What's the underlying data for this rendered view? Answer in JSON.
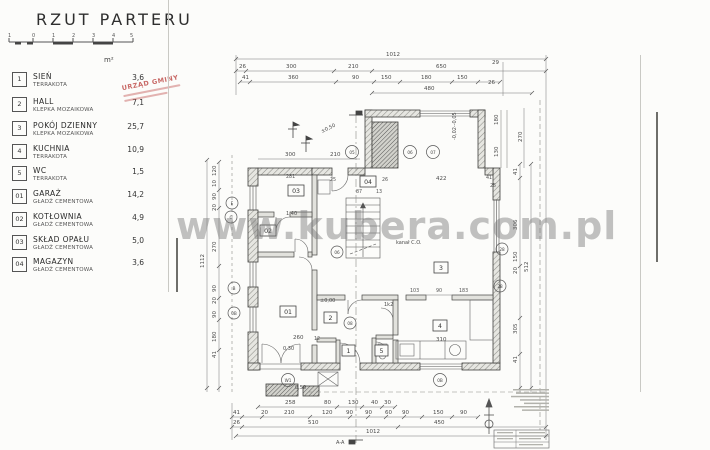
{
  "page": {
    "watermark": "www.kubera.com.pl"
  },
  "stamp": {
    "line1": "URZĄD GMINY"
  },
  "legend": {
    "title": "RZUT PARTERU",
    "unit": "m²",
    "scale_ticks": [
      "1",
      "0",
      "1",
      "2",
      "3",
      "4",
      "5"
    ],
    "rows": [
      {
        "no": "1",
        "name": "SIEŃ",
        "material": "TERRAKOTA",
        "area": "3,6"
      },
      {
        "no": "2",
        "name": "HALL",
        "material": "KLEPKA MOZAIKOWA",
        "area": "7,1"
      },
      {
        "no": "3",
        "name": "POKÓJ DZIENNY",
        "material": "KLEPKA MOZAIKOWA",
        "area": "25,7"
      },
      {
        "no": "4",
        "name": "KUCHNIA",
        "material": "TERRAKOTA",
        "area": "10,9"
      },
      {
        "no": "5",
        "name": "WC",
        "material": "TERRAKOTA",
        "area": "1,5"
      },
      {
        "no": "01",
        "name": "GARAŻ",
        "material": "GŁADŹ CEMENTOWA",
        "area": "14,2"
      },
      {
        "no": "02",
        "name": "KOTŁOWNIA",
        "material": "GŁADŹ CEMENTOWA",
        "area": "4,9"
      },
      {
        "no": "03",
        "name": "SKŁAD OPAŁU",
        "material": "GŁADŹ CEMENTOWA",
        "area": "5,0"
      },
      {
        "no": "04",
        "name": "MAGAZYN",
        "material": "GŁADŹ CEMENTOWA",
        "area": "3,6"
      }
    ]
  },
  "plan": {
    "rooms": {
      "r1": "1",
      "r2": "2",
      "r3": "3",
      "r4": "4",
      "r5": "5",
      "r01": "01",
      "r02": "02",
      "r03": "03",
      "r04": "04"
    },
    "levels": {
      "l000": "±0,00",
      "l050": "±0,50",
      "l030": "0,30",
      "l05": "0,50",
      "l140": "1,40",
      "lm": "-0,02--0,05"
    },
    "notes": {
      "kanal": "kanał C.O.",
      "k2": "1k2",
      "section": "A-A"
    },
    "markers": {
      "m05": "05",
      "m06": "06",
      "m07": "07",
      "m06b": "06",
      "m08": "08",
      "mE": "E",
      "mC": "C",
      "mB": "B",
      "m0B": "0B",
      "m28a": "28",
      "m28b": "28",
      "mW1": "W1",
      "m0Bb": "0B"
    },
    "dims": {
      "total": "1012",
      "btotal": "1012",
      "ltotal": "1112",
      "rtotal": "512",
      "t480": "480",
      "t2": [
        "26",
        "300",
        "210",
        "650"
      ],
      "t3": [
        "41",
        "360",
        "90",
        "150",
        "180",
        "150"
      ],
      "b1": [
        "258",
        "80",
        "130",
        "40",
        "30"
      ],
      "b2": [
        "41",
        "20",
        "210",
        "120",
        "90",
        "90",
        "60",
        "90",
        "150",
        "90"
      ],
      "b3": [
        "26",
        "510",
        "450"
      ],
      "left": [
        "120",
        "10",
        "90",
        "20",
        "270",
        "90",
        "20",
        "90",
        "180",
        "41"
      ],
      "right": [
        "41",
        "306",
        "150",
        "20",
        "305",
        "41"
      ],
      "chim": [
        "29",
        "26",
        "180",
        "130",
        "270"
      ],
      "i300": "300",
      "i210": "210",
      "i281": "281",
      "i25": "25",
      "i26": "26",
      "i87": "87",
      "i13": "13",
      "i422": "422",
      "i41": "41",
      "i25b": "25",
      "i260": "260",
      "i12": "12",
      "i310": "310",
      "k1": "103",
      "k2": "90",
      "k3": "183"
    }
  }
}
